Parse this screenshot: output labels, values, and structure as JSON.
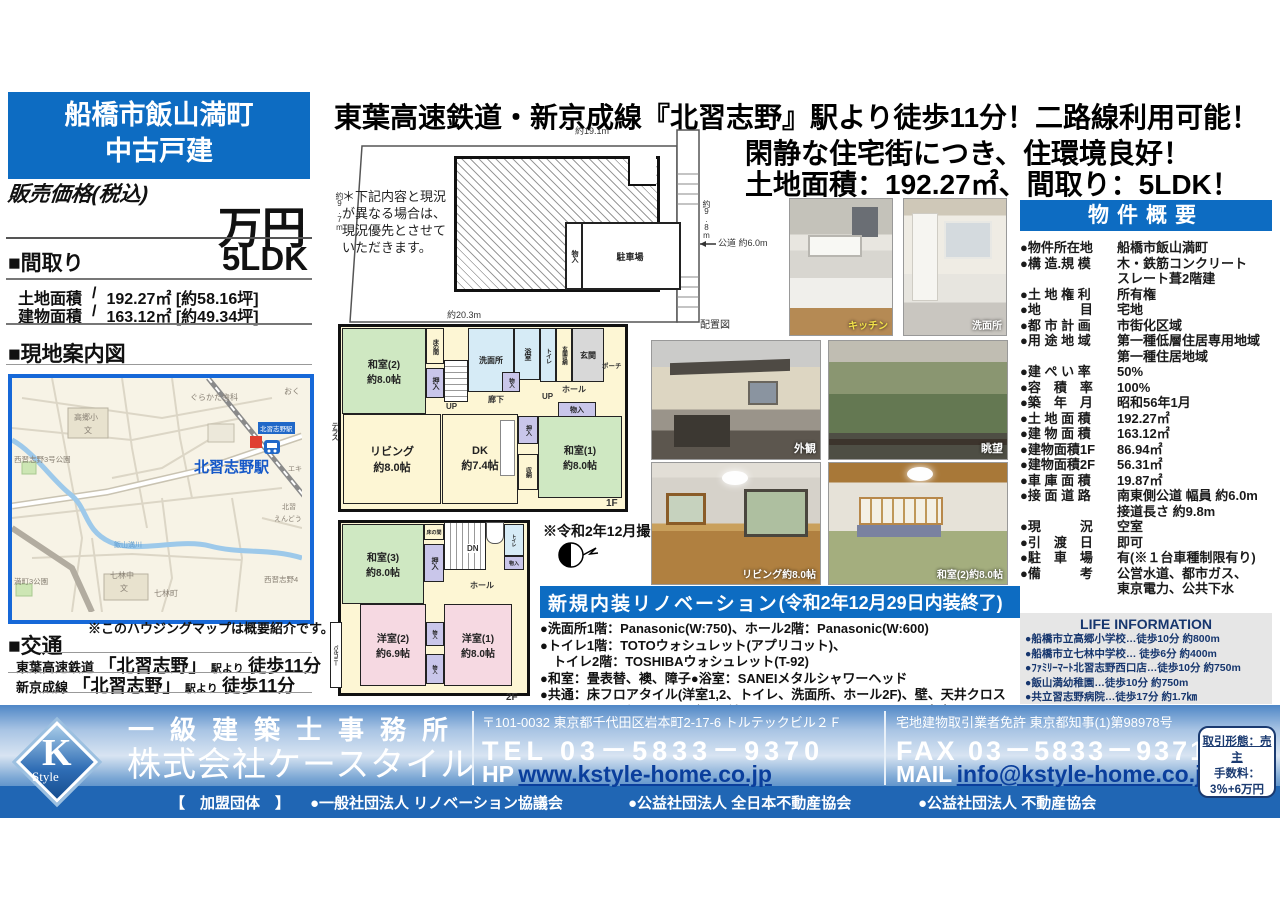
{
  "colors": {
    "brand_blue": "#0d6cc2",
    "map_border_blue": "#1668d8",
    "footer_link_blue": "#0a3e9c",
    "tatami_green": "#cfe8c2",
    "room_cream": "#fdf6d4",
    "room_pink": "#f6d9e2",
    "closet_lavender": "#c9c6ea"
  },
  "left": {
    "title_line1": "船橋市飯山満町",
    "title_line2": "中古戸建",
    "price_label": "販売価格(税込)",
    "price_unit": "万円",
    "madori_label": "■間取り",
    "madori_value": "5LDK",
    "areas": [
      {
        "label": "土地面積",
        "sep": "/",
        "value": "192.27㎡ [約58.16坪]"
      },
      {
        "label": "建物面積",
        "sep": "/",
        "value": "163.12㎡ [約49.34坪]"
      }
    ],
    "map_title": "■現地案内図",
    "map_note": "※このハウジングマップは概要紹介です。",
    "access_title": "■交通",
    "access_rows": [
      {
        "railway": "東葉高速鉄道",
        "station": "「北習志野」",
        "suffix": "駅より",
        "walk": "徒歩11分"
      },
      {
        "railway": "新京成線",
        "station": "「北習志野」",
        "suffix": "駅より",
        "walk": "徒歩11分"
      }
    ]
  },
  "map": {
    "labels": [
      "ぐらかた歯科",
      "おく",
      "高郷小",
      "文",
      "西習志野3号公園",
      "北習志野駅",
      "北習志野駅",
      "エキ",
      "北習",
      "えんどう",
      "飯山満川",
      "七林中",
      "文",
      "満町3公園",
      "七林町",
      "西習志野4"
    ]
  },
  "headline": {
    "line1": "東葉高速鉄道・新京成線『北習志野』駅より徒歩11分！二路線利用可能！",
    "line2": "閑静な住宅街につき、住環境良好！",
    "line3": "土地面積：192.27㎡、間取り：5LDK！"
  },
  "siteplan": {
    "note": "＊下記内容と現況が異なる場合は、現況優先とさせていただきます。",
    "dim_top": "約19.1m",
    "dim_bottom": "約20.3m",
    "dim_left": "約9.7m",
    "dim_right": "約9.8m",
    "road": "公道 約6.0m",
    "parking": "駐車場",
    "storage": "物入",
    "caption": "配置図"
  },
  "plan1f": {
    "floor": "1F",
    "rooms": {
      "washitsu2_name": "和室(2)",
      "washitsu2_size": "約8.0帖",
      "tokonoma": "床の間",
      "oshiire": "押入",
      "senmenjo": "洗面所",
      "yokushitsu": "浴室",
      "toilet": "トイレ",
      "genkan_shuno": "玄関収納",
      "genkan": "玄関",
      "porch": "ポーチ",
      "hall": "ホール",
      "rouka": "廊下",
      "up": "UP",
      "monoire": "物入",
      "living_name": "リビング",
      "living_size": "約8.0帖",
      "dk_name": "DK",
      "dk_size": "約7.4帖",
      "shuno": "収納",
      "washitsu1_name": "和室(1)",
      "washitsu1_size": "約8.0帖",
      "terrace": "テラス"
    }
  },
  "plan2f": {
    "floor": "2F",
    "rooms": {
      "washitsu3_name": "和室(3)",
      "washitsu3_size": "約8.0帖",
      "tokonoma": "床の間",
      "oshiire": "押入",
      "dn": "DN",
      "toilet": "トイレ",
      "monoire": "物入",
      "hall": "ホール",
      "yoshitsu2_name": "洋室(2)",
      "yoshitsu2_size": "約6.9帖",
      "yoshitsu1_name": "洋室(1)",
      "yoshitsu1_size": "約8.0帖",
      "balcony": "バルコニー"
    }
  },
  "photo_note": "※令和2年12月撮影",
  "photos": {
    "kitchen": "キッチン",
    "washroom": "洗面所",
    "exterior": "外観",
    "view": "眺望",
    "living": "リビング約8.0帖",
    "washitsu": "和室(2)約8.0帖"
  },
  "renovation": {
    "title_main": "新規内装リノベーション",
    "title_paren": "(令和2年12月29日内装終了)",
    "lines": [
      "●洗面所1階：Panasonic(W:750)、ホール2階：Panasonic(W:600)",
      "●トイレ1階：TOTOウォシュレット(アプリコット)、",
      "　トイレ2階：TOSHIBAウォシュレット(T-92)",
      "●和室：畳表替、襖、障子●浴室：SANEIメタルシャワーヘッド",
      "●共通：床フロアタイル(洋室1,2、トイレ、洗面所、ホール2F)、壁、天井クロス",
      "　　　　３口ガスコンロ(グリル付)、カーテンレール、照明器具、室内クリーニング等"
    ]
  },
  "overview": {
    "title": "物件概要",
    "rows": [
      {
        "label": "●物件所在地",
        "value": "船橋市飯山満町"
      },
      {
        "label": "●構 造.規 模",
        "value": "木・鉄筋コンクリート\nスレート葺2階建"
      },
      {
        "label": "●土 地 権 利",
        "value": "所有権"
      },
      {
        "label": "●地　　　目",
        "value": "宅地"
      },
      {
        "label": "●都 市 計 画",
        "value": "市街化区域"
      },
      {
        "label": "●用 途 地 域",
        "value": "第一種低層住居専用地域\n第一種住居地域"
      },
      {
        "label": "●建 ぺ い 率",
        "value": "50%"
      },
      {
        "label": "●容　積　率",
        "value": "100%"
      },
      {
        "label": "●築　年　月",
        "value": "昭和56年1月"
      },
      {
        "label": "●土 地 面 積",
        "value": "192.27㎡"
      },
      {
        "label": "●建 物 面 積",
        "value": "163.12㎡"
      },
      {
        "label": "●建物面積1F",
        "value": "86.94㎡"
      },
      {
        "label": "●建物面積2F",
        "value": "56.31㎡"
      },
      {
        "label": "●車 庫 面 積",
        "value": "19.87㎡"
      },
      {
        "label": "●接 面 道 路",
        "value": "南東側公道 幅員 約6.0m\n接道長さ 約9.8m"
      },
      {
        "label": "●現　　　況",
        "value": "空室"
      },
      {
        "label": "●引　渡　日",
        "value": "即可"
      },
      {
        "label": "●駐　車　場",
        "value": "有(※１台車種制限有り)"
      },
      {
        "label": "●備　　　考",
        "value": "公営水道、都市ガス、\n東京電力、公共下水"
      }
    ]
  },
  "life": {
    "title": "LIFE INFORMATION",
    "items": [
      "●船橋市立高郷小学校…徒歩10分 約800m",
      "●船橋市立七林中学校… 徒歩6分 約400m",
      "●ﾌｧﾐﾘｰﾏｰﾄ北習志野西口店…徒歩10分 約750m",
      "●飯山満幼稚園…徒歩10分 約750m",
      "●共立習志野病院…徒歩17分 約1.7㎞"
    ]
  },
  "footer": {
    "logo_k": "K",
    "logo_style": "Style",
    "office_type": "一級建築士事務所",
    "company": "株式会社ケースタイル",
    "member_label": "【　加盟団体　】",
    "members": [
      "●一般社団法人 リノベーション協議会",
      "●公益社団法人 全日本不動産協会",
      "●公益社団法人 不動産協会"
    ],
    "address": "〒101-0032 東京都千代田区岩本町2-17-6 トルテックビル２Ｆ",
    "license": "宅地建物取引業者免許 東京都知事(1)第98978号",
    "tel_label": "TEL",
    "tel": "03－5833－9370",
    "fax_label": "FAX",
    "fax": "03－5833－9371",
    "hp_label": "HP",
    "hp": "www.kstyle-home.co.jp",
    "mail_label": "MAIL",
    "mail": "info@kstyle-home.co.jp",
    "deal_line1": "取引形態：売主",
    "deal_line2": "手数料：",
    "deal_line3": "3％+6万円"
  }
}
